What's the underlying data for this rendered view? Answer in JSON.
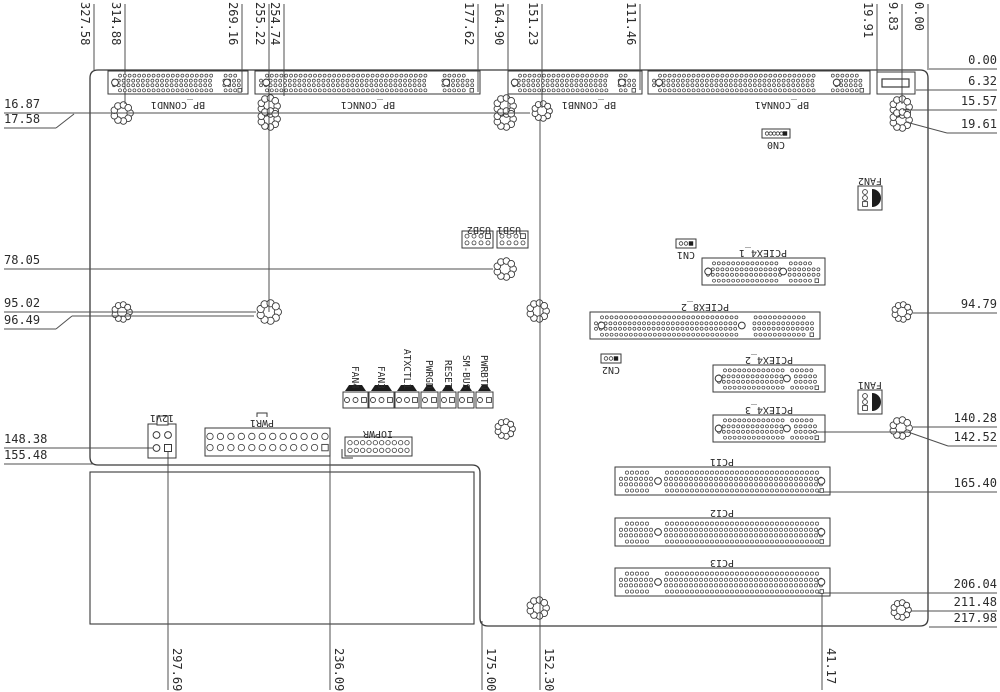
{
  "drawing_title": "backplane-board-dimension-drawing",
  "colors": {
    "line": "#3a3a3a",
    "dim_line": "#4f4f4f",
    "text": "#2b2b2b",
    "fill": "#ffffff",
    "dark": "#1c1c1c"
  },
  "board": {
    "x1": 90,
    "y1": 70,
    "x2": 928,
    "y2": 626,
    "notch_x": 480,
    "notch_y": 465,
    "corner_r": 8,
    "inner_rect": {
      "x": 90,
      "y": 472,
      "w": 384,
      "h": 152
    }
  },
  "dims": {
    "top": [
      {
        "value": "327.58",
        "x": 94,
        "yTo": 70
      },
      {
        "value": "314.88",
        "x": 125,
        "yTo": 104
      },
      {
        "value": "269.16",
        "x": 242,
        "yTo": 92
      },
      {
        "value": "255.22",
        "x": 269,
        "yTo": 312
      },
      {
        "value": "254.74",
        "x": 284,
        "yTo": 96
      },
      {
        "value": "177.62",
        "x": 478,
        "yTo": 92
      },
      {
        "value": "164.90",
        "x": 508,
        "yTo": 112
      },
      {
        "value": "151.23",
        "x": 542,
        "yTo": 108
      },
      {
        "value": "111.46",
        "x": 640,
        "yTo": 90
      },
      {
        "value": "19.91",
        "x": 877,
        "yTo": 86
      },
      {
        "value": "9.83",
        "x": 902,
        "yTo": 104
      },
      {
        "value": "0.00",
        "x": 928,
        "yTo": 70
      }
    ],
    "bottom": [
      {
        "value": "297.69",
        "x": 168,
        "yFrom": 450
      },
      {
        "value": "236.09",
        "x": 330,
        "yFrom": 450
      },
      {
        "value": "175.00",
        "x": 482,
        "yFrom": 621
      },
      {
        "value": "152.30",
        "x": 540,
        "yFrom": 120
      },
      {
        "value": "41.17",
        "x": 822,
        "yFrom": 593
      }
    ],
    "left": [
      {
        "value": "16.87",
        "y": 113,
        "x2": 530
      },
      {
        "value": "17.58",
        "y": 128,
        "x2": 56,
        "diag": [
          56,
          128,
          74,
          114
        ]
      },
      {
        "value": "78.05",
        "y": 269,
        "x2": 493
      },
      {
        "value": "95.02",
        "y": 312,
        "x2": 256
      },
      {
        "value": "96.49",
        "y": 329,
        "x2": 56,
        "diag": [
          56,
          329,
          72,
          316
        ],
        "extra": [
          72,
          316,
          254,
          316
        ]
      },
      {
        "value": "148.38",
        "y": 448,
        "x2": 154
      },
      {
        "value": "155.48",
        "y": 464,
        "x2": 93
      }
    ],
    "right": [
      {
        "value": "0.00",
        "y": 69,
        "x1": 929
      },
      {
        "value": "6.32",
        "y": 90,
        "x1": 916
      },
      {
        "value": "15.57",
        "y": 110,
        "x1": 903
      },
      {
        "value": "19.61",
        "y": 133,
        "x1": 947,
        "diag": [
          906,
          122,
          947,
          133
        ]
      },
      {
        "value": "94.79",
        "y": 313,
        "x1": 913
      },
      {
        "value": "140.28",
        "y": 427,
        "x1": 913
      },
      {
        "value": "142.52",
        "y": 446,
        "x1": 948,
        "diag": [
          908,
          432,
          948,
          446
        ],
        "extra": [
          812,
          432,
          908,
          432
        ]
      },
      {
        "value": "165.40",
        "y": 492,
        "x1": 818
      },
      {
        "value": "206.04",
        "y": 593,
        "x1": 818
      },
      {
        "value": "211.48",
        "y": 611,
        "x1": 911
      },
      {
        "value": "217.98",
        "y": 627,
        "x1": 929
      }
    ]
  },
  "holes": [
    {
      "x": 122,
      "y": 113,
      "r": 11
    },
    {
      "x": 269,
      "y": 106,
      "r": 11
    },
    {
      "x": 269,
      "y": 119,
      "r": 11
    },
    {
      "x": 505,
      "y": 106,
      "r": 11
    },
    {
      "x": 505,
      "y": 119,
      "r": 11
    },
    {
      "x": 542,
      "y": 111,
      "r": 10
    },
    {
      "x": 901,
      "y": 107,
      "r": 11
    },
    {
      "x": 901,
      "y": 120,
      "r": 11
    },
    {
      "x": 505,
      "y": 269,
      "r": 11
    },
    {
      "x": 122,
      "y": 312,
      "r": 10
    },
    {
      "x": 269,
      "y": 312,
      "r": 12
    },
    {
      "x": 538,
      "y": 311,
      "r": 11
    },
    {
      "x": 902,
      "y": 312,
      "r": 10
    },
    {
      "x": 505,
      "y": 429,
      "r": 10
    },
    {
      "x": 901,
      "y": 428,
      "r": 11
    },
    {
      "x": 538,
      "y": 608,
      "r": 11
    },
    {
      "x": 901,
      "y": 610,
      "r": 10
    }
  ],
  "components": [
    {
      "id": "bp-connd1",
      "label": "BP_CONND1",
      "type": "slot",
      "style": "bp",
      "x": 108,
      "y": 71,
      "w": 140,
      "h": 23,
      "lab": {
        "x": 178,
        "y": 99,
        "rot": 180
      }
    },
    {
      "id": "bp-connc1",
      "label": "BP_CONNC1",
      "type": "slot",
      "style": "bp",
      "x": 255,
      "y": 71,
      "w": 225,
      "h": 23,
      "lab": {
        "x": 368,
        "y": 99,
        "rot": 180
      }
    },
    {
      "id": "bp-connb1",
      "label": "BP_CONNB1",
      "type": "slot",
      "style": "bp",
      "x": 508,
      "y": 71,
      "w": 134,
      "h": 23,
      "lab": {
        "x": 589,
        "y": 99,
        "rot": 180
      }
    },
    {
      "id": "bp-conna1",
      "label": "BP_CONNA1",
      "type": "slot",
      "style": "bp",
      "x": 648,
      "y": 71,
      "w": 222,
      "h": 23,
      "lab": {
        "x": 782,
        "y": 99,
        "rot": 180
      }
    },
    {
      "id": "pciex4-1",
      "label": "PCIEX4_1",
      "type": "slot",
      "style": "pcie",
      "x": 702,
      "y": 258,
      "w": 123,
      "h": 27,
      "lab": {
        "x": 763,
        "y": 247,
        "rot": 180
      }
    },
    {
      "id": "pciex8-2",
      "label": "PCIEX8_2",
      "type": "slot",
      "style": "pcie",
      "x": 590,
      "y": 312,
      "w": 230,
      "h": 27,
      "lab": {
        "x": 705,
        "y": 301,
        "rot": 180
      }
    },
    {
      "id": "pciex4-2",
      "label": "PCIEX4_2",
      "type": "slot",
      "style": "pcie",
      "x": 713,
      "y": 365,
      "w": 112,
      "h": 27,
      "lab": {
        "x": 769,
        "y": 354,
        "rot": 180
      }
    },
    {
      "id": "pciex4-3",
      "label": "PCIEX4_3",
      "type": "slot",
      "style": "pcie",
      "x": 713,
      "y": 415,
      "w": 112,
      "h": 27,
      "lab": {
        "x": 769,
        "y": 404,
        "rot": 180
      }
    },
    {
      "id": "pci1",
      "label": "PCI1",
      "type": "slot",
      "style": "pci",
      "x": 615,
      "y": 467,
      "w": 215,
      "h": 28,
      "lab": {
        "x": 722,
        "y": 456,
        "rot": 180
      }
    },
    {
      "id": "pci2",
      "label": "PCI2",
      "type": "slot",
      "style": "pci",
      "x": 615,
      "y": 518,
      "w": 215,
      "h": 28,
      "lab": {
        "x": 722,
        "y": 507,
        "rot": 180
      }
    },
    {
      "id": "pci3",
      "label": "PCI3",
      "type": "slot",
      "style": "pci",
      "x": 615,
      "y": 568,
      "w": 215,
      "h": 28,
      "lab": {
        "x": 722,
        "y": 557,
        "rot": 180
      }
    },
    {
      "id": "cn0",
      "label": "CN0",
      "type": "pinrow",
      "x": 762,
      "y": 129,
      "w": 28,
      "h": 9,
      "rows": 1,
      "cols": 6,
      "pr": 1.7,
      "lab": {
        "x": 776,
        "y": 139,
        "rot": 180
      }
    },
    {
      "id": "cn1",
      "label": "CN1",
      "type": "pinrow",
      "x": 676,
      "y": 239,
      "w": 20,
      "h": 9,
      "rows": 1,
      "cols": 3,
      "pr": 1.8,
      "lab": {
        "x": 686,
        "y": 249,
        "rot": 180
      }
    },
    {
      "id": "cn2",
      "label": "CN2",
      "type": "pinrow",
      "x": 601,
      "y": 354,
      "w": 20,
      "h": 9,
      "rows": 1,
      "cols": 3,
      "pr": 1.8,
      "lab": {
        "x": 611,
        "y": 364,
        "rot": 180
      }
    },
    {
      "id": "usb2-header",
      "label": "",
      "type": "pinrow",
      "x": 462,
      "y": 231,
      "w": 31,
      "h": 17,
      "rows": 2,
      "cols": 4,
      "pr": 2.0,
      "keysq": true
    },
    {
      "id": "usb1-header",
      "label": "",
      "type": "pinrow",
      "x": 497,
      "y": 231,
      "w": 31,
      "h": 17,
      "rows": 2,
      "cols": 4,
      "pr": 2.0,
      "keysq": true
    },
    {
      "id": "usb-label",
      "label": "USB1 USB2",
      "type": "label",
      "lab": {
        "x": 494,
        "y": 224,
        "rot": 180
      }
    },
    {
      "id": "iopwr",
      "label": "IOPWR",
      "type": "pinrow",
      "x": 345,
      "y": 437,
      "w": 67,
      "h": 19,
      "rows": 2,
      "cols": 10,
      "pr": 2.2,
      "lmark": true,
      "lab": {
        "x": 378,
        "y": 428,
        "rot": 180
      }
    },
    {
      "id": "pwr1",
      "label": "PWR1",
      "type": "pinrow",
      "x": 205,
      "y": 428,
      "w": 125,
      "h": 28,
      "rows": 2,
      "cols": 12,
      "pr": 3.2,
      "sq_last": true,
      "bracket": true,
      "lab": {
        "x": 262,
        "y": 417,
        "rot": 180
      }
    },
    {
      "id": "12v1",
      "label": "12V1",
      "type": "atx12v",
      "x": 148,
      "y": 424,
      "w": 28,
      "h": 34,
      "lab": {
        "x": 162,
        "y": 412,
        "rot": 180
      }
    },
    {
      "id": "fan2",
      "label": "FAN2",
      "type": "fan",
      "x": 858,
      "y": 186,
      "w": 24,
      "h": 24,
      "lab": {
        "x": 870,
        "y": 175,
        "rot": 180
      }
    },
    {
      "id": "fan1",
      "label": "FAN1",
      "type": "fan",
      "x": 858,
      "y": 390,
      "w": 24,
      "h": 24,
      "lab": {
        "x": 870,
        "y": 379,
        "rot": 180
      }
    },
    {
      "id": "fan4",
      "label": "FAN4",
      "type": "latched",
      "x": 343,
      "y": 392,
      "w": 25,
      "h": 16,
      "pins": 3,
      "lab": {
        "x": 355,
        "rot": 90
      }
    },
    {
      "id": "fan3",
      "label": "FAN3",
      "type": "latched",
      "x": 369,
      "y": 392,
      "w": 25,
      "h": 16,
      "pins": 3,
      "lab": {
        "x": 381,
        "rot": 90
      }
    },
    {
      "id": "atxctl1",
      "label": "ATXCTL1",
      "type": "latched",
      "x": 395,
      "y": 392,
      "w": 24,
      "h": 16,
      "pins": 3,
      "lab": {
        "x": 407,
        "rot": 90
      }
    },
    {
      "id": "pwrgd",
      "label": "PWRGD",
      "type": "latched",
      "x": 421,
      "y": 392,
      "w": 17,
      "h": 16,
      "pins": 2,
      "lab": {
        "x": 429,
        "rot": 90
      }
    },
    {
      "id": "reset",
      "label": "RESET",
      "type": "latched",
      "x": 440,
      "y": 392,
      "w": 16,
      "h": 16,
      "pins": 2,
      "lab": {
        "x": 448,
        "rot": 90
      }
    },
    {
      "id": "sm-bus",
      "label": "SM-BUS",
      "type": "latched",
      "x": 458,
      "y": 392,
      "w": 16,
      "h": 16,
      "pins": 2,
      "lab": {
        "x": 466,
        "rot": 90
      }
    },
    {
      "id": "pwrbtn",
      "label": "PWRBTN",
      "type": "latched",
      "x": 476,
      "y": 392,
      "w": 17,
      "h": 16,
      "pins": 2,
      "lab": {
        "x": 484,
        "rot": 90
      }
    },
    {
      "id": "conn-top-right",
      "label": "",
      "type": "bar",
      "x": 877,
      "y": 72,
      "w": 38,
      "h": 22
    }
  ]
}
